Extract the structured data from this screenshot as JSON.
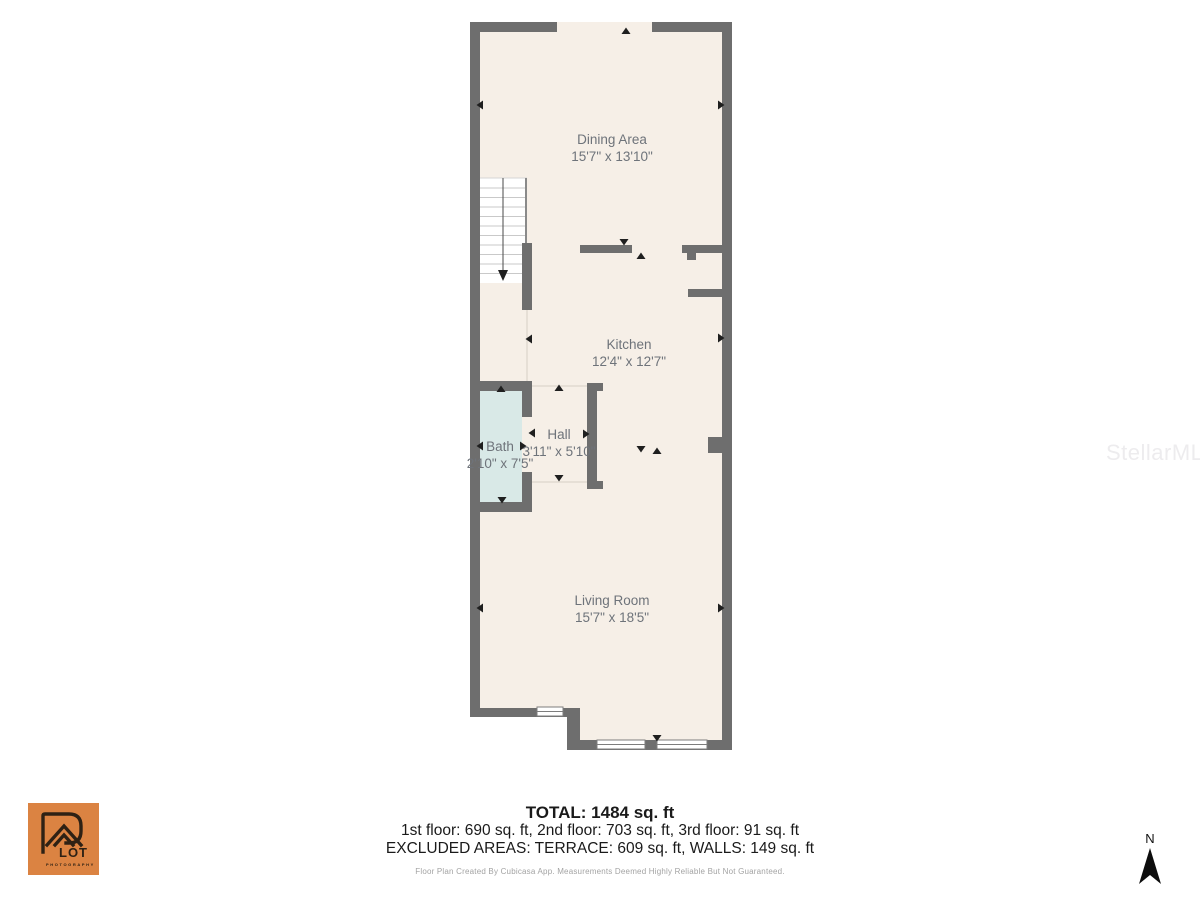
{
  "floorplan": {
    "rooms": [
      {
        "name": "Dining Area",
        "dims": "15'7\" x 13'10\""
      },
      {
        "name": "Kitchen",
        "dims": "12'4\" x 12'7\""
      },
      {
        "name": "Bath",
        "dims": "2'10\" x 7'5\""
      },
      {
        "name": "Hall",
        "dims": "3'11\" x 5'10\""
      },
      {
        "name": "Living Room",
        "dims": "15'7\" x 18'5\""
      }
    ]
  },
  "summary": {
    "total": "TOTAL: 1484 sq. ft",
    "floors": "1st floor: 690 sq. ft, 2nd floor: 703 sq. ft, 3rd floor: 91 sq. ft",
    "excluded": "EXCLUDED AREAS: TERRACE: 609 sq. ft, WALLS: 149 sq. ft",
    "disclaimer": "Floor Plan Created By Cubicasa App. Measurements Deemed Highly Reliable But Not Guaranteed."
  },
  "logo": {
    "name": "LOT",
    "sub": "PHOTOGRAPHY"
  },
  "compass": {
    "label": "N"
  },
  "watermark": {
    "text": "StellarMLS"
  },
  "colors": {
    "floor": "#f6efe7",
    "wall": "#6e6e6e",
    "bath": "#d9e9e7",
    "label": "#6e737a",
    "marker": "#1f1f1f",
    "logo-bg": "#db8342",
    "logo-ink": "#2e2114",
    "text-dark": "#1a1a1a",
    "disclaimer": "#a3a3a3",
    "watermark": "#edecee"
  }
}
